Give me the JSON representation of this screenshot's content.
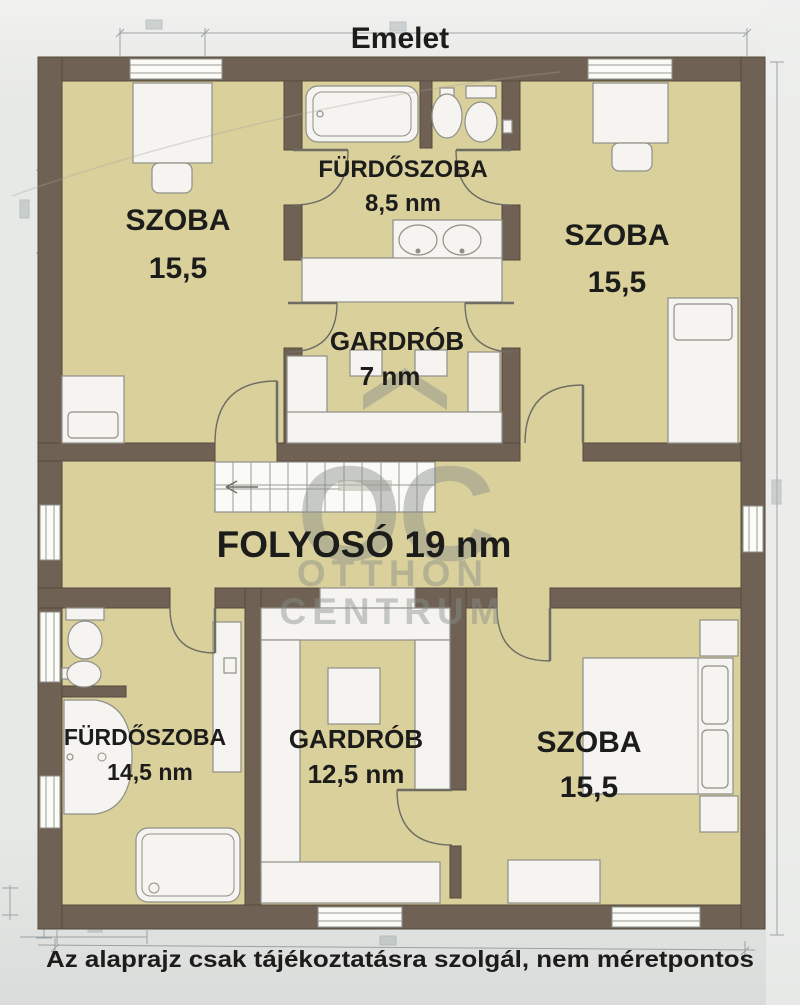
{
  "title": "Emelet",
  "caption": "Az alaprajz csak tájékoztatásra szolgál, nem méretpontos",
  "watermark": {
    "monogram": "OC",
    "line1": "OTTHON",
    "line2": "CENTRUM"
  },
  "rooms": {
    "szoba_top_left": {
      "name": "SZOBA",
      "area": "15,5"
    },
    "furdoszoba_top": {
      "name": "FÜRDŐSZOBA",
      "area": "8,5 nm"
    },
    "szoba_top_right": {
      "name": "SZOBA",
      "area": "15,5"
    },
    "gardrob_top": {
      "name": "GARDRÓB",
      "area": "7 nm"
    },
    "folyoso": {
      "label": "FOLYOSÓ 19 nm"
    },
    "furdoszoba_bottom": {
      "name": "FÜRDŐSZOBA",
      "area": "14,5 nm"
    },
    "gardrob_bottom": {
      "name": "GARDRÓB",
      "area": "12,5 nm"
    },
    "szoba_bottom_right": {
      "name": "SZOBA",
      "area": "15,5"
    }
  },
  "colors": {
    "wall": "#6f6254",
    "room": "#d9d09c",
    "furn": "#f5f4f0",
    "furnstroke": "#8f8f88",
    "label": "#1c1c1a",
    "wm": "#8b8f8b",
    "dim": "#8e979b",
    "bgtop": "#f1f1ef",
    "bg": "#e7e9e6",
    "bgbot": "#d9dcda"
  }
}
